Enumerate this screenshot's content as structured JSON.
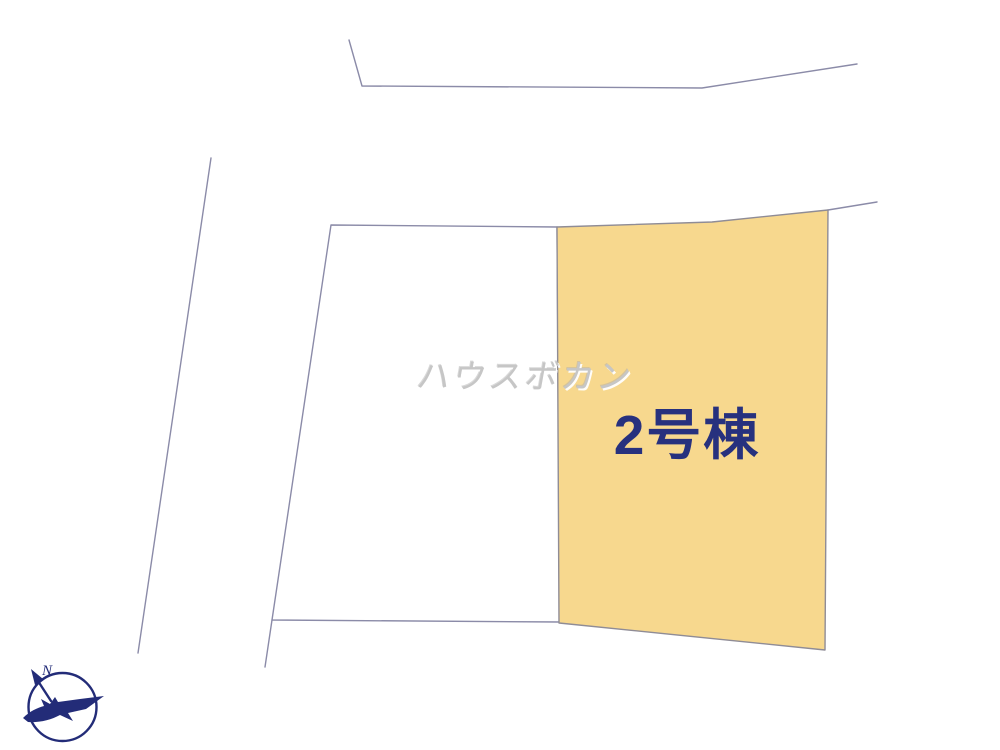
{
  "plan": {
    "background": "#ffffff"
  },
  "colors": {
    "line": "#8b8ba8",
    "lot2_stroke": "#8f8c96",
    "compass": "#232c78"
  },
  "lot2": {
    "label": "2号棟",
    "fill_color": "#f7d88e",
    "label_color": "#27317e"
  },
  "watermark": {
    "text": "ハウスボカン",
    "color": "#c6c6c6"
  },
  "compass": {
    "north_label": "N"
  }
}
